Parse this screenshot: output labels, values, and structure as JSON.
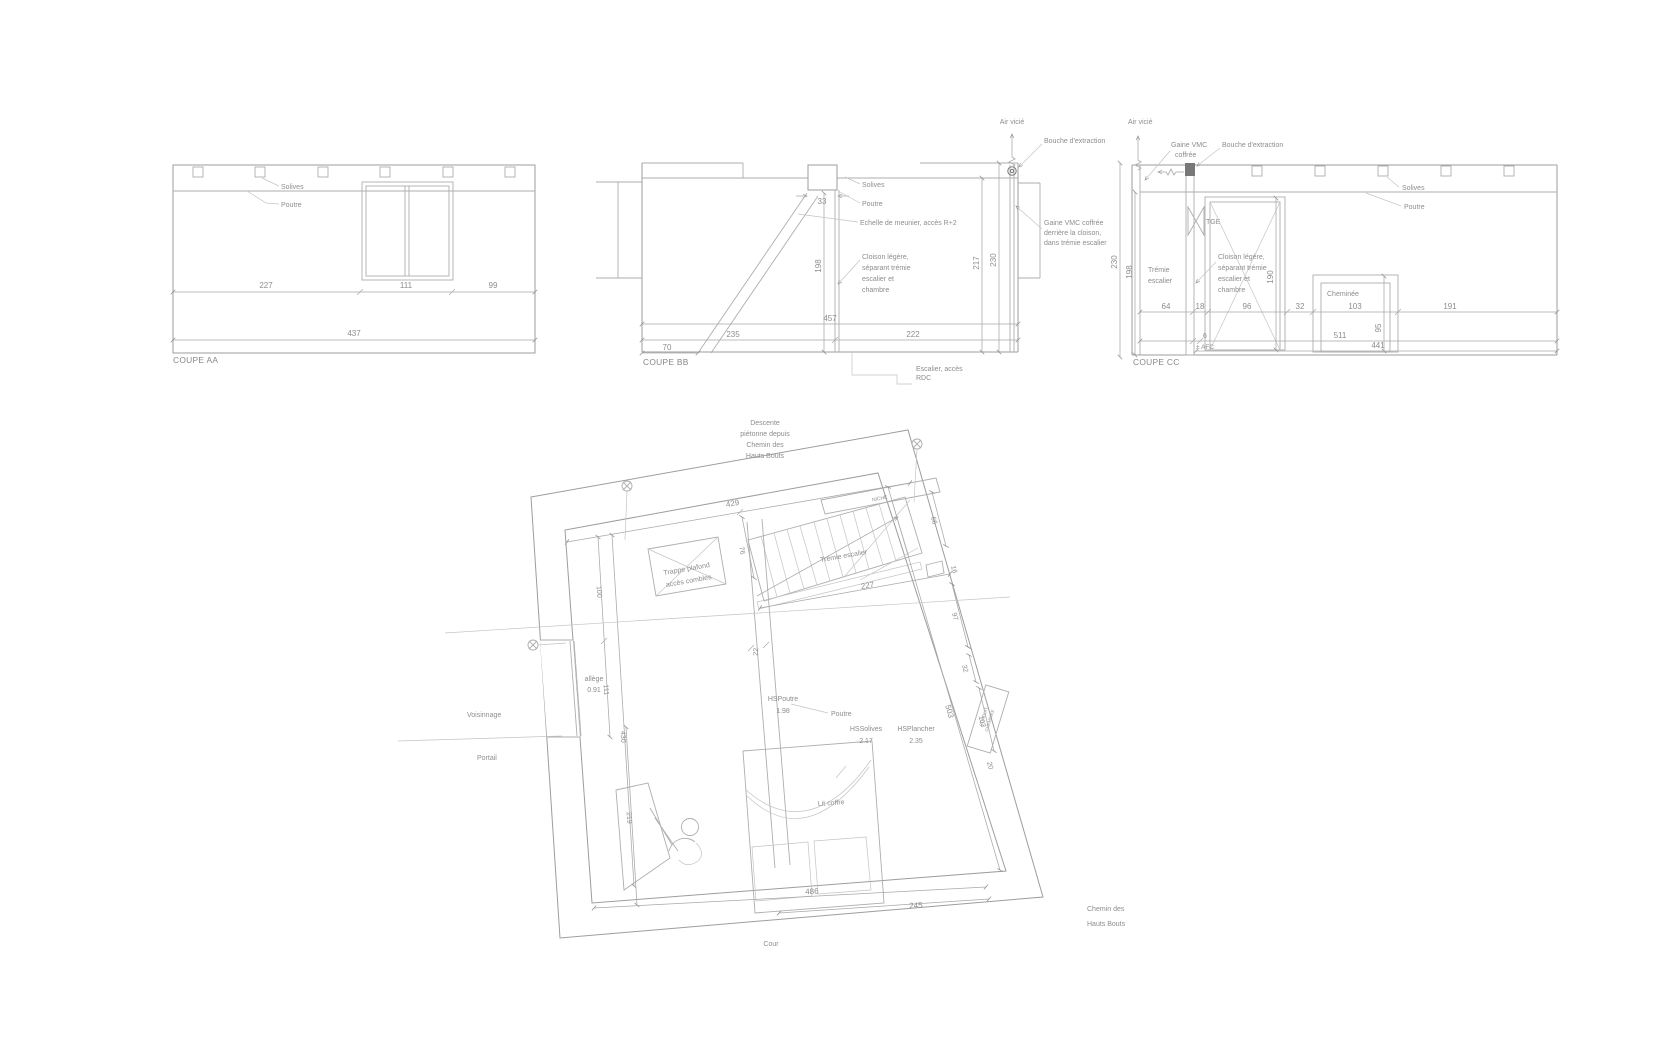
{
  "aa": {
    "caption": "COUPE AA",
    "solives": "Solives",
    "poutre": "Poutre",
    "dims": {
      "a": "227",
      "b": "111",
      "c": "99",
      "total": "437"
    }
  },
  "bb": {
    "caption": "COUPE BB",
    "air": "Air vicié",
    "bouche": "Bouche d'extraction",
    "solives": "Solives",
    "poutre": "Poutre",
    "echelle": "Echelle de meunier, accès R+2",
    "cloison": [
      "Cloison légère,",
      "séparant trémie",
      "escalier et",
      "chambre"
    ],
    "gaine": [
      "Gaine VMC coffrée",
      "derrière la cloison,",
      "dans trémie escalier"
    ],
    "escalier": [
      "Escalier, accès",
      "RDC"
    ],
    "dims": {
      "w": "33",
      "h1": "198",
      "h2": "217",
      "h3": "230",
      "total": "457",
      "a": "235",
      "b": "222",
      "c": "70"
    }
  },
  "cc": {
    "caption": "COUPE CC",
    "air": "Air vicié",
    "gaine": [
      "Gaine VMC",
      "coffrée"
    ],
    "bouche": "Bouche d'extraction",
    "tge": "TGE",
    "tremie": [
      "Trémie",
      "escalier"
    ],
    "cloison": [
      "Cloison légère,",
      "séparant trémie",
      "escalier et",
      "chambre"
    ],
    "cheminee": "Cheminée",
    "solives": "Solives",
    "poutre": "Poutre",
    "dims": {
      "h1": "230",
      "h2": "198",
      "door": "190",
      "chem": "95",
      "a": "64",
      "b": "18",
      "c": "96",
      "d": "32",
      "e": "103",
      "f": "191",
      "g": "6",
      "afc": "± AFC",
      "t1": "511",
      "t2": "441"
    }
  },
  "plan": {
    "descente": [
      "Descente",
      "piétonne depuis",
      "Chemin des",
      "Hauts Bouts"
    ],
    "niche": "NICHE",
    "tremie": "Trémie escalier",
    "trappe": [
      "Trappe plafond",
      "accès combles"
    ],
    "allege": [
      "allège",
      "0.91"
    ],
    "voisinnage": "Voisinnage",
    "portail": "Portail",
    "cour": "Cour",
    "chemin": [
      "Chemin des",
      "Hauts Bouts"
    ],
    "lit": "Lit coffre",
    "hspoutre": [
      "HSPoutre",
      "1.98"
    ],
    "poutre": "Poutre",
    "hssolives": [
      "HSSolives",
      "2.17"
    ],
    "hsplancher": [
      "HSPlancher",
      "2.35"
    ],
    "conduit": [
      "CONDUIT",
      "CHEMINÉE"
    ],
    "dims": {
      "d429": "429",
      "d76": "76",
      "d227": "227",
      "d66": "66",
      "d16": "16",
      "d97": "97",
      "d32": "32",
      "d503": "503",
      "d103": "103",
      "d20": "20",
      "d100": "100",
      "d111": "111",
      "d430": "430",
      "d219": "219",
      "d22": "22",
      "d486": "486",
      "d245": "245"
    }
  }
}
